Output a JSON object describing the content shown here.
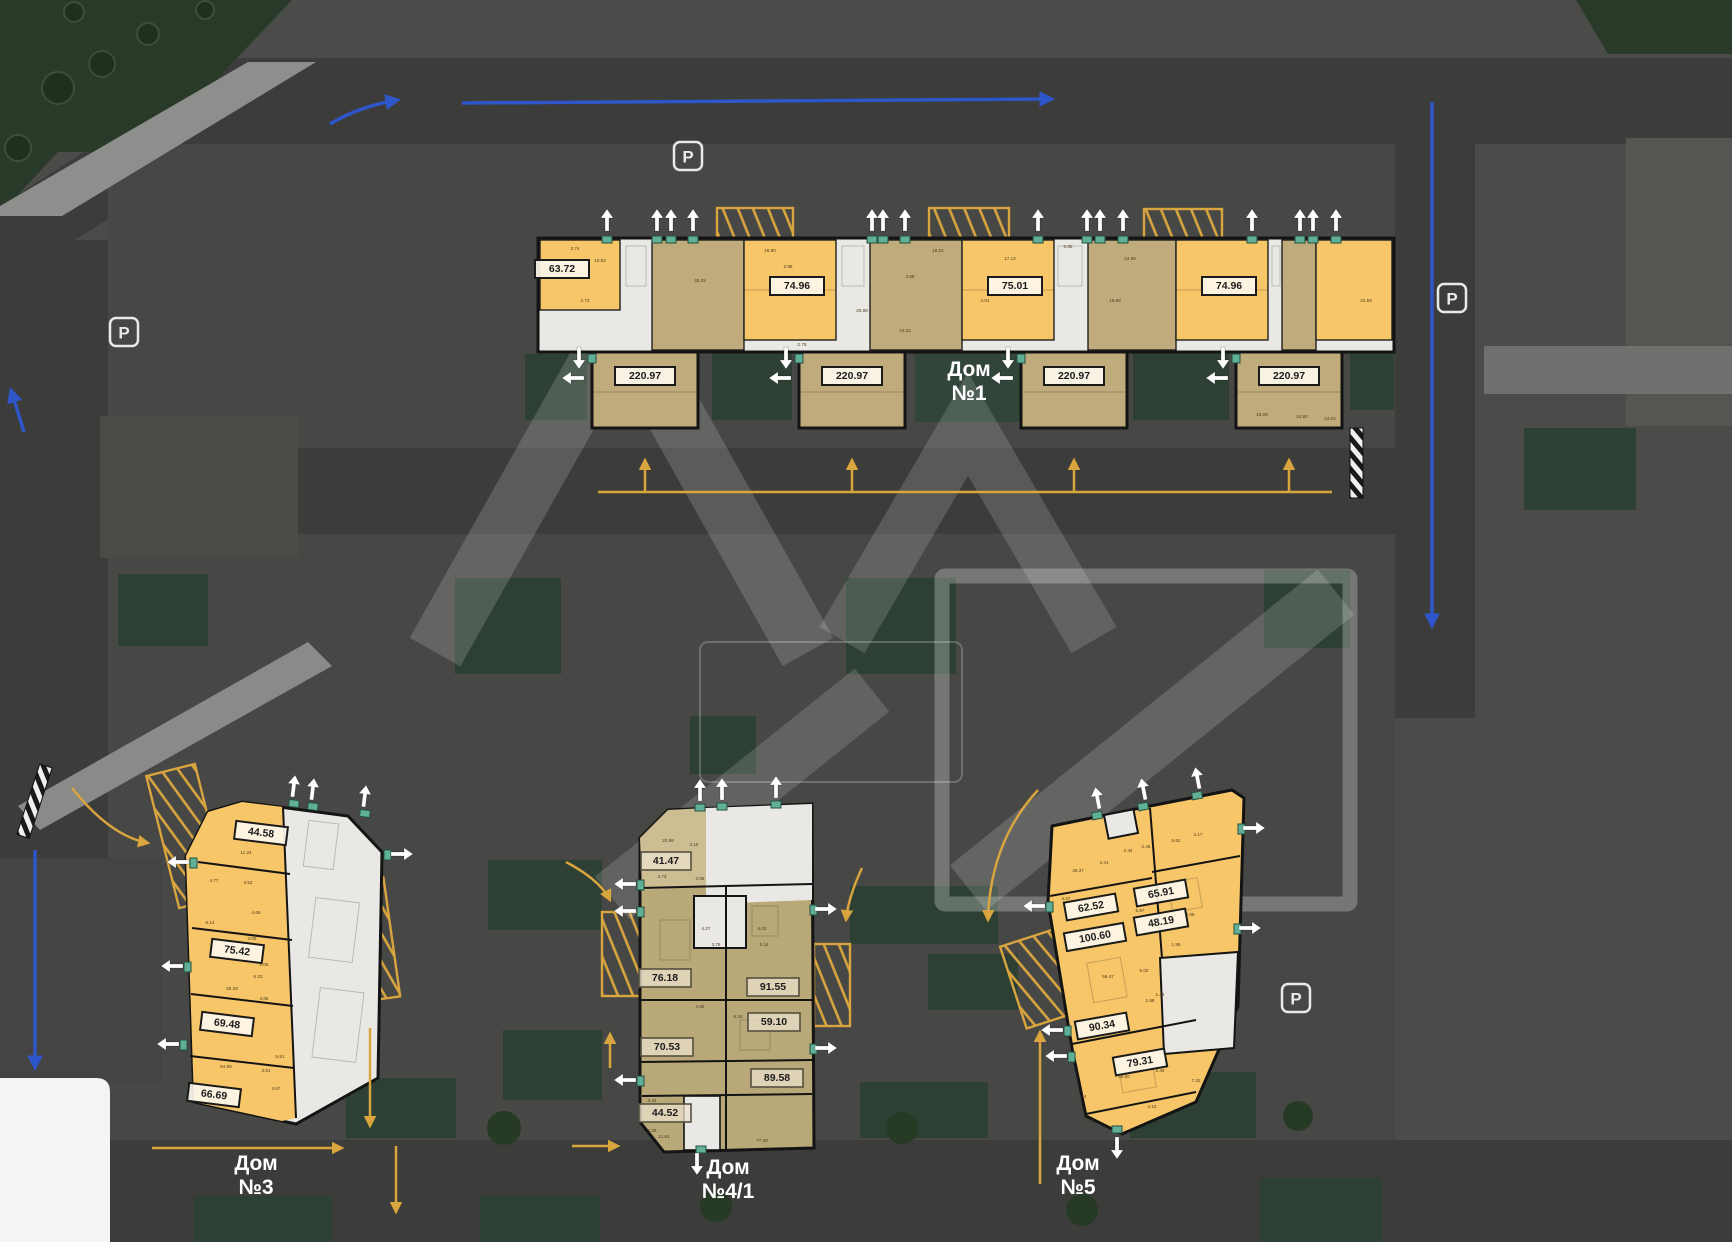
{
  "plan": {
    "buildings": [
      {
        "name_line1": "Дом",
        "name_line2": "№1",
        "apartments": [
          "63.72",
          "74.96",
          "75.01",
          "74.96",
          "220.97",
          "220.97",
          "220.97",
          "220.97"
        ],
        "room_dims": [
          "3.74",
          "10.84",
          "2.73",
          "45.25",
          "2.98",
          "16.80",
          "18.01",
          "17.12",
          "24.32",
          "20.88",
          "4.01",
          "5.85",
          "3.85",
          "16.88",
          "2.78",
          "24.96",
          "22.59",
          "16.28",
          "24.80",
          "24.04"
        ]
      },
      {
        "name_line1": "Дом",
        "name_line2": "№3",
        "apartments": [
          "44.58",
          "75.42",
          "69.48",
          "66.69"
        ],
        "room_dims": [
          "11.24",
          "4.77",
          "3.52",
          "4.68",
          "5.14",
          "3.06",
          "2.06",
          "56.29",
          "4.65",
          "5.23",
          "54.96",
          "3.61",
          "3.67",
          "5.81"
        ]
      },
      {
        "name_line1": "Дом",
        "name_line2": "№4/1",
        "apartments": [
          "41.47",
          "76.18",
          "91.55",
          "59.10",
          "70.53",
          "89.58",
          "44.52"
        ],
        "room_dims": [
          "20.96",
          "4.15",
          "4.73",
          "3.86",
          "4.27",
          "4.02",
          "5.16",
          "3.76",
          "5.34",
          "4.65",
          "3.44",
          "4.25",
          "11.61",
          "77.38"
        ]
      },
      {
        "name_line1": "Дом",
        "name_line2": "№5",
        "apartments": [
          "62.52",
          "65.91",
          "48.19",
          "100.60",
          "90.34",
          "79.31"
        ],
        "room_dims": [
          "48.37",
          "3.41",
          "2.44",
          "2.46",
          "5.62",
          "4.17",
          "5.87",
          "4.57",
          "4.05",
          "1.99",
          "58.47",
          "5.02",
          "1.98",
          "1.46",
          "56.60",
          "5.49",
          "3.44",
          "4.25",
          "7.32",
          "4.10"
        ]
      }
    ],
    "parking_icon_letter": "P",
    "colors": {
      "apartment_available": "#F6C668",
      "apartment_alt": "#BFAB7C",
      "building_common": "#EAE8E5",
      "road": "#3C3C3A",
      "ground": "#4B4B49",
      "green": "#2E4033",
      "accent_yellow": "#D8A53F",
      "accent_blue": "#2E56C9",
      "entrance_marker": "#5FB096",
      "white_arrow": "#FFFFFF"
    }
  }
}
